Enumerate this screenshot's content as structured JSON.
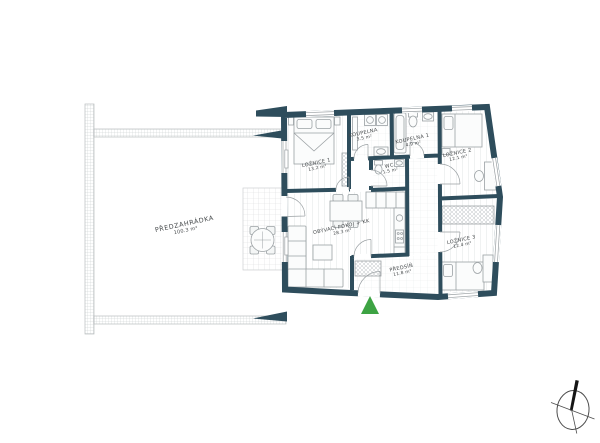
{
  "floor_plan": {
    "rooms": [
      {
        "id": "predzahradka",
        "name": "PŘEDZAHRÁDKA",
        "area": "100.3 m²"
      },
      {
        "id": "loznice-1",
        "name": "LOŽNICE 1",
        "area": "13.2 m²"
      },
      {
        "id": "koupelna",
        "name": "KOUPELNA",
        "area": "3.5 m²"
      },
      {
        "id": "koupelna-1",
        "name": "KOUPELNA 1",
        "area": "4.9 m²"
      },
      {
        "id": "wc",
        "name": "WC",
        "area": "1.5 m²"
      },
      {
        "id": "loznice-2",
        "name": "LOŽNICE 2",
        "area": "12.1 m²"
      },
      {
        "id": "obyvaci-pokoj",
        "name": "OBÝVACÍ POKOJ + KK",
        "area": "28.3 m²"
      },
      {
        "id": "loznice-3",
        "name": "LOŽNICE 3",
        "area": "12.4 m²"
      },
      {
        "id": "predsin",
        "name": "PŘEDSÍŇ",
        "area": "11.8 m²"
      }
    ],
    "icons": {
      "entrance_marker": "green-triangle-up",
      "compass": "north-arrow"
    },
    "colors": {
      "wall": "#2e4d5c",
      "entrance": "#3da343",
      "furniture_line": "#9ba1a4",
      "hatch": "#c6cacc",
      "label": "#45494b"
    }
  }
}
